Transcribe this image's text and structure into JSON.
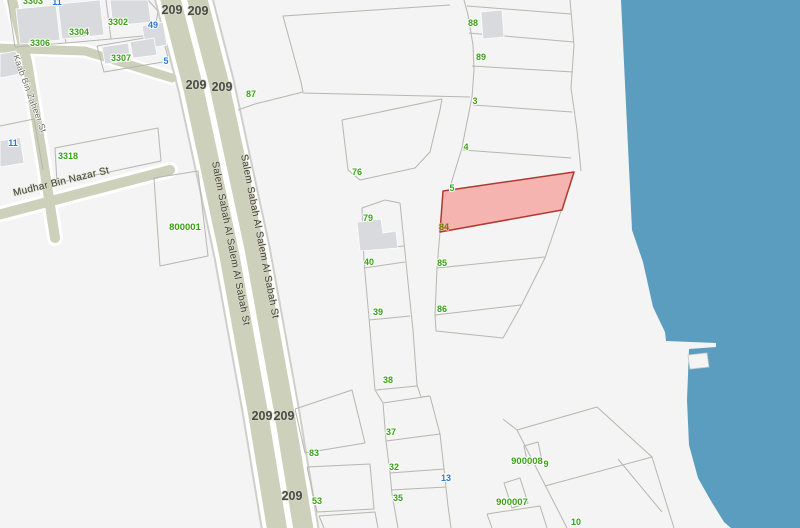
{
  "streets": {
    "main": "Salem Sabah Al Salem Al Sabah St",
    "mudhar": "Mudhar Bin Nazar St",
    "kaab": "Kaab Bin Zaheer St"
  },
  "route_numbers": [
    "209",
    "209",
    "209",
    "209",
    "209",
    "209",
    "209"
  ],
  "parcel_labels": [
    "3303",
    "3302",
    "3304",
    "3306",
    "3307",
    "3318",
    "800001",
    "87",
    "76",
    "79",
    "40",
    "39",
    "38",
    "88",
    "89",
    "3",
    "4",
    "5",
    "85",
    "86",
    "83",
    "53",
    "37",
    "32",
    "35",
    "900008",
    "9",
    "900007",
    "10"
  ],
  "blue_labels": [
    "11",
    "49",
    "5",
    "11",
    "13"
  ],
  "highlighted_parcel": {
    "number": "84"
  },
  "colors": {
    "water": "#5b9dbe",
    "road": "#cdd0ba",
    "land": "#f3f4f3",
    "highlight_fill": "#f5a8a2",
    "highlight_border": "#b03a31",
    "parcel_label_green": "#3aa017",
    "unit_label_blue": "#2679d8",
    "route_number_gray": "#4a4a46"
  }
}
